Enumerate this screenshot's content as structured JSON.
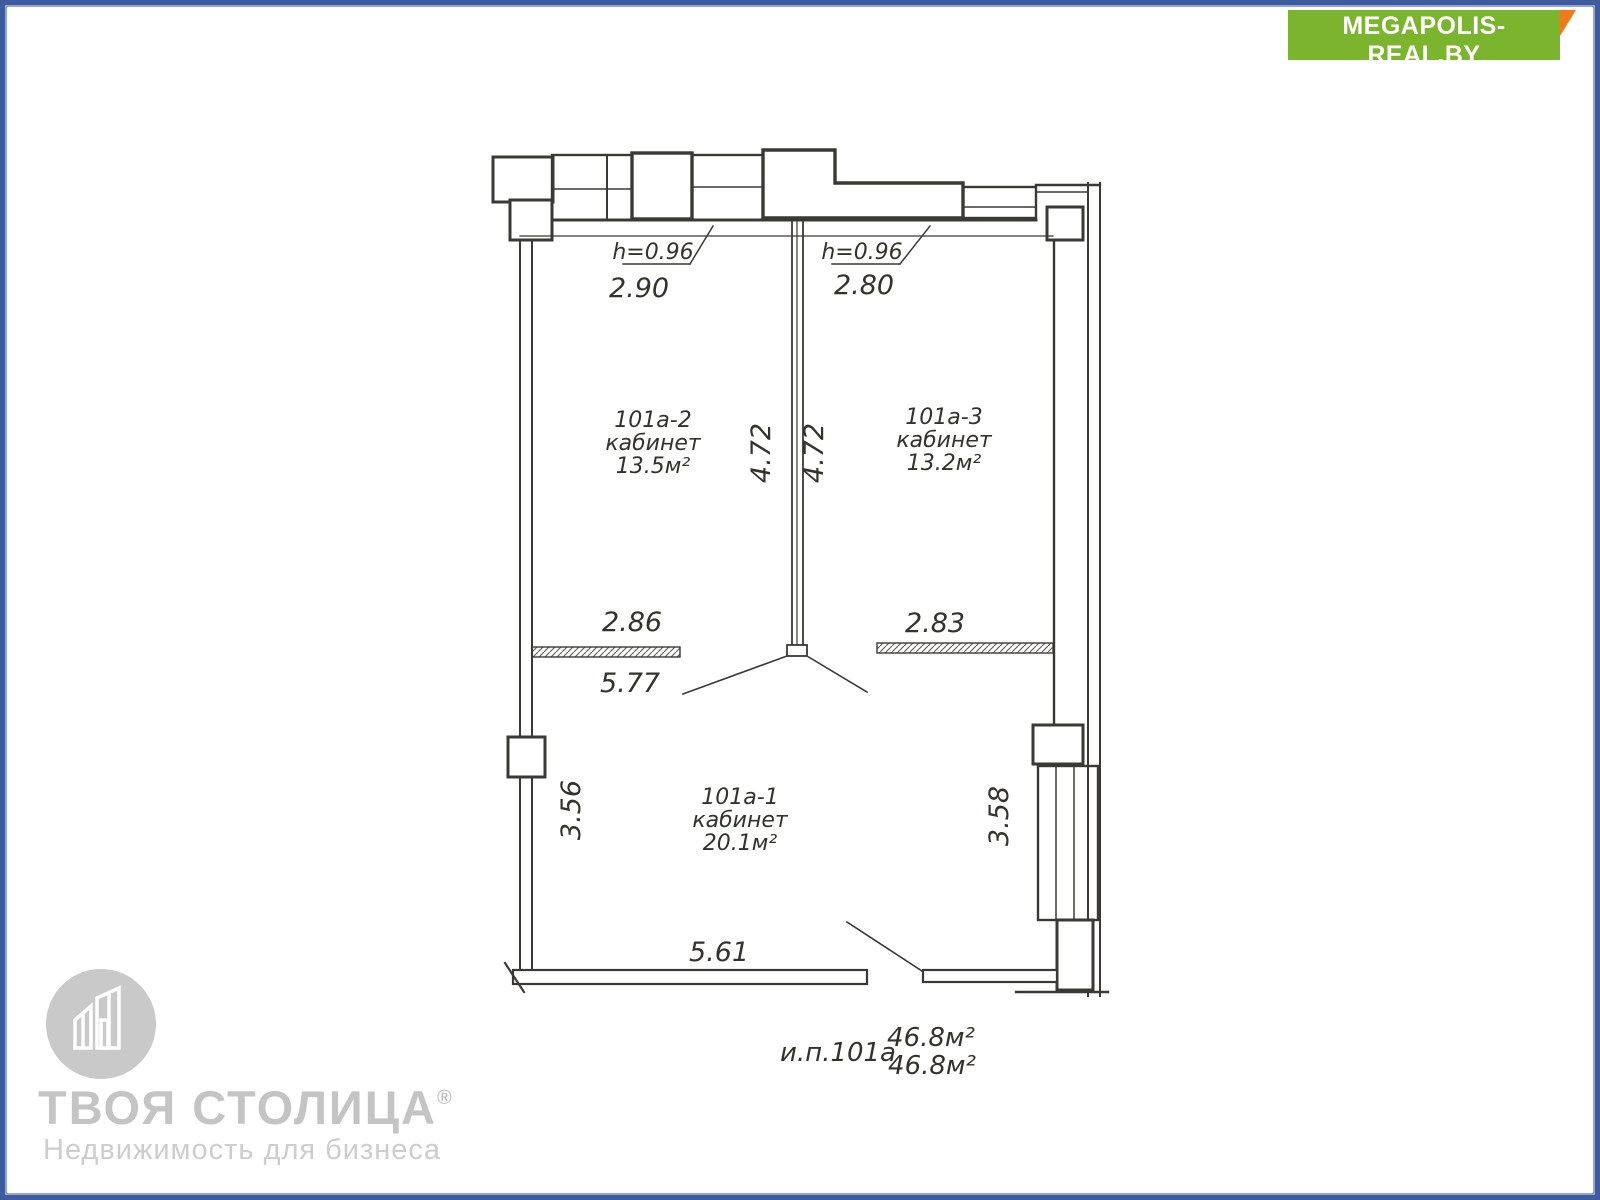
{
  "badge": {
    "title": "MEGAPOLIS-REAL.BY",
    "subtitle": "портал о коммерческой недвижимости в Беларуси",
    "bg_color": "#7bb42d",
    "fold_color": "#ee7b16"
  },
  "watermark": {
    "brand": "ТВОЯ СТОЛИЦА",
    "reg": "®",
    "tagline": "Недвижимость для бизнеса",
    "color": "#c4c4c4"
  },
  "plan": {
    "line_color": "#3a3935",
    "rooms": [
      {
        "number": "101а-2",
        "type": "кабинет",
        "area": "13.5м²"
      },
      {
        "number": "101а-3",
        "type": "кабинет",
        "area": "13.2м²"
      },
      {
        "number": "101а-1",
        "type": "кабинет",
        "area": "20.1м²"
      }
    ],
    "dimensions": {
      "sill_height_left": "h=0.96",
      "sill_height_right": "h=0.96",
      "window_width_left": "2.90",
      "window_width_right": "2.80",
      "depth_left": "4.72",
      "depth_right": "4.72",
      "room2_width": "2.86",
      "room3_width": "2.83",
      "hall_width": "5.77",
      "room1_height_left": "3.56",
      "room1_height_right": "3.58",
      "room1_width": "5.61"
    },
    "summary": {
      "unit": "и.п.101а",
      "area_top": "46.8м²",
      "area_bottom": "46.8м²"
    }
  }
}
